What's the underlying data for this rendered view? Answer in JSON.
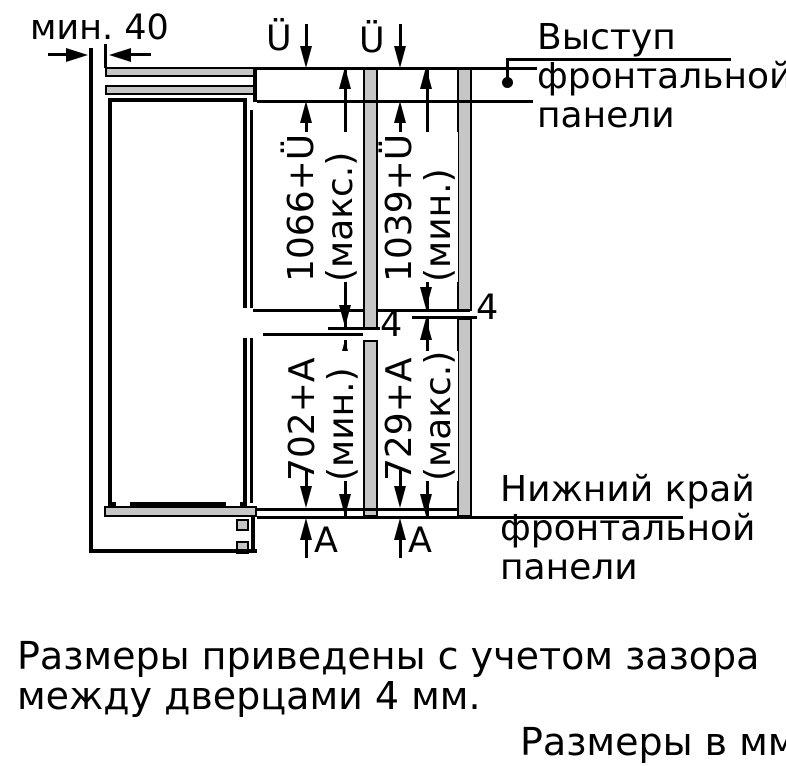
{
  "figure": {
    "min_gap_label": "мин. 40",
    "overlap_top_left": "Ü",
    "overlap_top_right": "Ü",
    "overlap_bottom_left": "A",
    "overlap_bottom_right": "A",
    "gap_center": "4",
    "gap_right": "4",
    "dim_upper_max": {
      "value": "1066+Ü",
      "qualifier": "(макс.)"
    },
    "dim_upper_min": {
      "value": "1039+Ü",
      "qualifier": "(мин.)"
    },
    "dim_lower_min": {
      "value": "702+A",
      "qualifier": "(мин.)"
    },
    "dim_lower_max": {
      "value": "729+A",
      "qualifier": "(макс.)"
    },
    "callout_top": {
      "line1": "Выступ",
      "line2": "фронтальной",
      "line3": "панели"
    },
    "callout_bottom": {
      "line1": "Нижний край",
      "line2": "фронтальной",
      "line3": "панели"
    }
  },
  "notes": {
    "gap_note_line1": "Размеры приведены с учетом зазора",
    "gap_note_line2": "между дверцами 4 мм.",
    "units_note": "Размеры в мм"
  },
  "colors": {
    "line": "#000000",
    "panel_fill": "#c6c6c6",
    "background": "#ffffff"
  }
}
